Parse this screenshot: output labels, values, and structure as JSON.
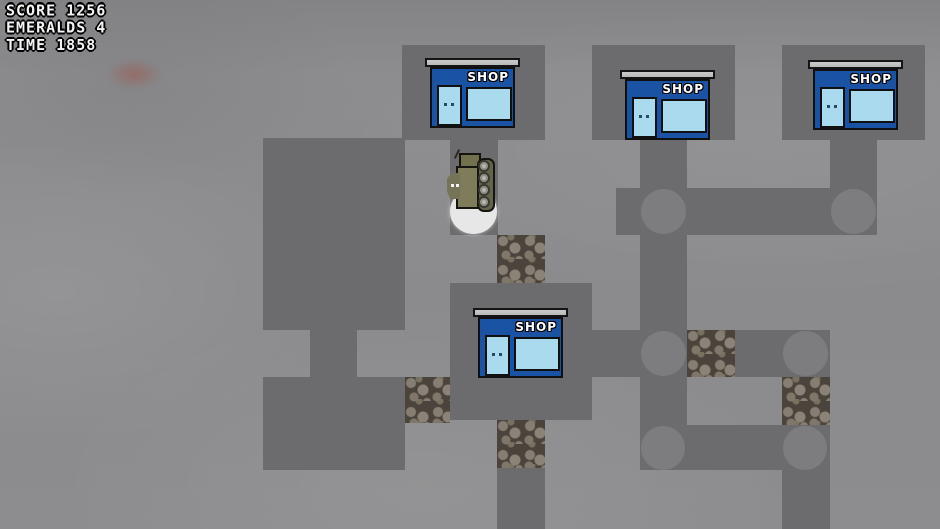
{
  "hud": {
    "lines": [
      {
        "label": "SCORE",
        "value": "1256",
        "text": "SCORE 1256"
      },
      {
        "label": "EMERALDS",
        "value": "4",
        "text": "EMERALDS 4"
      },
      {
        "label": "TIME",
        "value": "1858",
        "text": "TIME 1858"
      }
    ]
  },
  "shops": {
    "count": 4,
    "sign_label": "SHOP"
  },
  "player": {
    "sprite": "olive-tank",
    "state": "standing-on-white-glow"
  },
  "colors": {
    "background": "#8d8d8f",
    "sky_top": "#838386",
    "road": "#6c6c6e",
    "intersection_circle": "#7d7d7f",
    "cobblestone": "#4a443c",
    "shop_blue": "#1a52a4",
    "shop_glass": "#a9daee",
    "shop_awning": "#cacaca",
    "player_olive": "#7e7c5b",
    "wheel_gray": "#b6b6ae",
    "spawn_glow": "#e7e7e7",
    "hud_text": "#f4f4f4"
  }
}
